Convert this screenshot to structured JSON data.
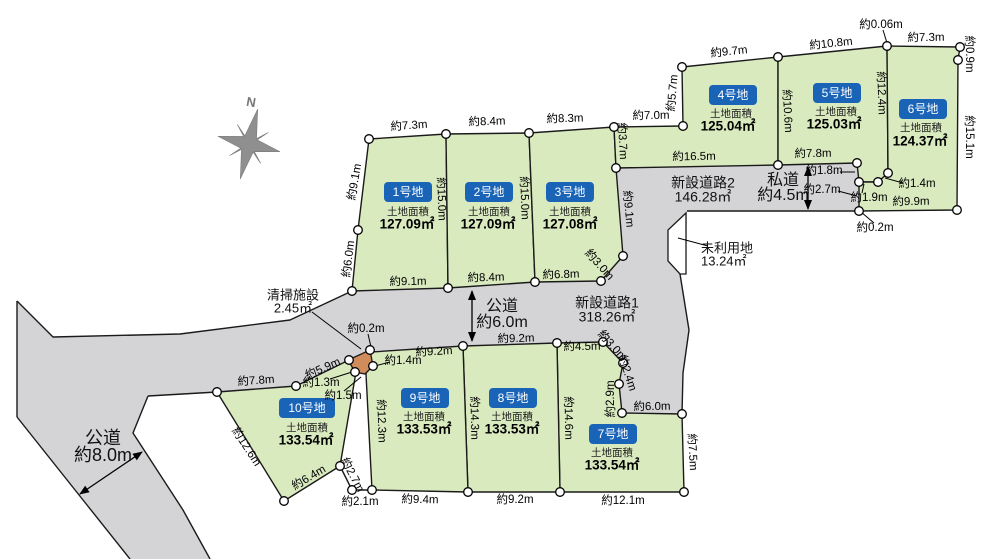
{
  "colors": {
    "background": "#ffffff",
    "lot_fill": "#d9eabf",
    "road_fill": "#d4d4d6",
    "outline": "#1a1a1a",
    "badge_fill": "#1a64b8",
    "badge_text": "#ffffff",
    "facility_fill": "#d08c5a",
    "unused_fill": "#ffffff",
    "compass_fill": "#8f8f8f",
    "dim_text": "#000000"
  },
  "compass": {
    "label": "N",
    "cx": 249,
    "cy": 144,
    "rotation": 14,
    "label_x": 251,
    "label_y": 103
  },
  "road_polygons": [
    {
      "name": "road-left-public",
      "points": "17,301 53,337 180,334 290,320 352,291 372,350 349,360 296,386 217,392 148,396 133,433 183,510 210,559 130,559 87,505 17,417"
    },
    {
      "name": "road-central-network",
      "points": "352,291 448,288 535,282 601,281 623,256 616,168 778,165 857,163 859,182 859,211 687,211 686,274 680,274 689,330 683,373 682,414 622,413 619,384 623,363 603,342 557,343 463,346 372,351 373,366 365,374 355,372 349,360 296,386 217,392 148,396"
    }
  ],
  "road_outlines": [
    {
      "name": "road-left-top-edge",
      "points": "17,301 53,337 180,334 290,320 352,291"
    },
    {
      "name": "road-left-west-edge",
      "points": "17,301 17,417"
    },
    {
      "name": "road-left-southwest-edge",
      "points": "17,417 87,505 130,559"
    },
    {
      "name": "road-left-southeast-edge",
      "points": "148,396 133,433 183,510 210,559"
    },
    {
      "name": "road-bottom-edge-west",
      "points": "148,396 217,392"
    },
    {
      "name": "private-road-bottom-edge",
      "points": "687,211 859,211"
    },
    {
      "name": "road-connector-east-edge",
      "points": "680,274 689,330 683,373 682,414"
    },
    {
      "name": "wedge-bottom-edge",
      "points": "340,466 352,490 372,490"
    }
  ],
  "unused_land": {
    "name": "unused-land-parcel",
    "points": "686,213 668,230 668,261 680,274 686,274"
  },
  "cleaning_facility": {
    "name": "cleaning-facility-parcel",
    "points": "370,350 373,366 365,374 355,372 348,360"
  },
  "lots": [
    {
      "id": 1,
      "badge": "1号地",
      "area_title": "土地面積",
      "area": "127.09㎡",
      "points": "369,139 446,134 448,288 352,291 358,230",
      "badge_cx": 408,
      "badge_cy": 192,
      "badge_w": 48,
      "title_cx": 408,
      "title_cy": 212,
      "value_cx": 407,
      "value_cy": 225
    },
    {
      "id": 2,
      "badge": "2号地",
      "area_title": "土地面積",
      "area": "127.09㎡",
      "points": "446,134 529,133 535,282 448,288",
      "badge_cx": 489,
      "badge_cy": 192,
      "badge_w": 48,
      "title_cx": 489,
      "title_cy": 212,
      "value_cx": 488,
      "value_cy": 225
    },
    {
      "id": 3,
      "badge": "3号地",
      "area_title": "土地面積",
      "area": "127.08㎡",
      "points": "529,133 614,127 616,168 623,256 601,281 535,282",
      "badge_cx": 570,
      "badge_cy": 192,
      "badge_w": 48,
      "title_cx": 570,
      "title_cy": 212,
      "value_cx": 570,
      "value_cy": 225
    },
    {
      "id": 4,
      "badge": "4号地",
      "area_title": "土地面積",
      "area": "125.04㎡",
      "points": "614,127 683,126 682,67 778,57 778,165 616,168",
      "badge_cx": 733,
      "badge_cy": 95,
      "badge_w": 48,
      "title_cx": 731,
      "title_cy": 114,
      "value_cx": 728,
      "value_cy": 127
    },
    {
      "id": 5,
      "badge": "5号地",
      "area_title": "土地面積",
      "area": "125.03㎡",
      "points": "778,57 887,46 888,173 878,182 859,182 857,163 778,165",
      "badge_cx": 837,
      "badge_cy": 93,
      "badge_w": 48,
      "title_cx": 836,
      "title_cy": 112,
      "value_cx": 834,
      "value_cy": 125
    },
    {
      "id": 6,
      "badge": "6号地",
      "area_title": "土地面積",
      "area": "124.37㎡",
      "points": "887,46 960,47 958,60 957,210 859,211 859,182 878,182 888,173",
      "badge_cx": 923,
      "badge_cy": 109,
      "badge_w": 48,
      "title_cx": 921,
      "title_cy": 128,
      "value_cx": 920,
      "value_cy": 142
    },
    {
      "id": 7,
      "badge": "7号地",
      "area_title": "土地面積",
      "area": "133.54㎡",
      "points": "557,343 603,342 623,363 619,384 622,413 682,414 684,492 560,492",
      "badge_cx": 613,
      "badge_cy": 434,
      "badge_w": 48,
      "title_cx": 612,
      "title_cy": 453,
      "value_cx": 612,
      "value_cy": 466
    },
    {
      "id": 8,
      "badge": "8号地",
      "area_title": "土地面積",
      "area": "133.53㎡",
      "points": "463,346 557,343 560,492 468,492",
      "badge_cx": 513,
      "badge_cy": 398,
      "badge_w": 48,
      "title_cx": 512,
      "title_cy": 417,
      "value_cx": 512,
      "value_cy": 430
    },
    {
      "id": 9,
      "badge": "9号地",
      "area_title": "土地面積",
      "area": "133.53㎡",
      "points": "371,352 463,346 468,492 372,490 366,374",
      "badge_cx": 425,
      "badge_cy": 398,
      "badge_w": 48,
      "title_cx": 424,
      "title_cy": 417,
      "value_cx": 424,
      "value_cy": 430
    },
    {
      "id": 10,
      "badge": "10号地",
      "area_title": "土地面積",
      "area": "133.54㎡",
      "points": "217,392 296,386 349,360 356,372 340,466 284,501",
      "badge_cx": 307,
      "badge_cy": 408,
      "badge_w": 56,
      "title_cx": 307,
      "title_cy": 428,
      "value_cx": 306,
      "value_cy": 441
    }
  ],
  "road_labels": [
    {
      "name": "public-road-8m-label",
      "lines": [
        "公道",
        "約8.0m"
      ],
      "x": 103,
      "y": 439,
      "size": 18,
      "lh": 17,
      "anchor": "middle"
    },
    {
      "name": "public-road-6m-label",
      "lines": [
        "公道",
        "約6.0m"
      ],
      "x": 502,
      "y": 307,
      "size": 16,
      "lh": 16,
      "anchor": "middle"
    },
    {
      "name": "new-road-1-label",
      "lines": [
        "新設道路1",
        "318.26㎡"
      ],
      "x": 607,
      "y": 304,
      "size": 14,
      "lh": 14,
      "anchor": "middle"
    },
    {
      "name": "new-road-2-label",
      "lines": [
        "新設道路2",
        "146.28㎡"
      ],
      "x": 703,
      "y": 184,
      "size": 14,
      "lh": 14,
      "anchor": "middle"
    },
    {
      "name": "private-road-label",
      "lines": [
        "私道",
        "約4.5m"
      ],
      "x": 783,
      "y": 181,
      "size": 16,
      "lh": 15,
      "anchor": "middle"
    },
    {
      "name": "unused-land-label",
      "lines": [
        "未利用地",
        "13.24㎡"
      ],
      "x": 701,
      "y": 249,
      "size": 13,
      "lh": 13,
      "anchor": "start"
    },
    {
      "name": "cleaning-facility-label",
      "lines": [
        "清掃施設",
        "2.45㎡"
      ],
      "x": 293,
      "y": 296,
      "size": 13,
      "lh": 13,
      "anchor": "middle"
    }
  ],
  "dim_labels": [
    {
      "t": "約7.3m",
      "x": 409,
      "y": 126,
      "r": -4
    },
    {
      "t": "約8.4m",
      "x": 487,
      "y": 122,
      "r": -2
    },
    {
      "t": "約8.3m",
      "x": 565,
      "y": 119,
      "r": -2
    },
    {
      "t": "約7.0m",
      "x": 651,
      "y": 116,
      "r": -1
    },
    {
      "t": "約9.7m",
      "x": 729,
      "y": 52,
      "r": -6
    },
    {
      "t": "約10.8m",
      "x": 831,
      "y": 44,
      "r": -6
    },
    {
      "t": "約0.06m",
      "x": 881,
      "y": 25,
      "r": 0
    },
    {
      "t": "約7.3m",
      "x": 926,
      "y": 38,
      "r": -1
    },
    {
      "t": "約0.9m",
      "x": 969,
      "y": 54,
      "r": 90
    },
    {
      "t": "約15.1m",
      "x": 969,
      "y": 137,
      "r": 90
    },
    {
      "t": "約5.7m",
      "x": 673,
      "y": 93,
      "r": -85
    },
    {
      "t": "約10.6m",
      "x": 787,
      "y": 111,
      "r": 87
    },
    {
      "t": "約12.4m",
      "x": 881,
      "y": 93,
      "r": 88
    },
    {
      "t": "約9.1m",
      "x": 355,
      "y": 182,
      "r": -80
    },
    {
      "t": "約6.0m",
      "x": 349,
      "y": 259,
      "r": -83
    },
    {
      "t": "約15.0m",
      "x": 441,
      "y": 199,
      "r": 88
    },
    {
      "t": "約15.0m",
      "x": 524,
      "y": 198,
      "r": 88
    },
    {
      "t": "約3.7m",
      "x": 622,
      "y": 141,
      "r": 87
    },
    {
      "t": "約9.1m",
      "x": 628,
      "y": 209,
      "r": 85
    },
    {
      "t": "約3.0m",
      "x": 599,
      "y": 265,
      "r": 48
    },
    {
      "t": "約9.1m",
      "x": 408,
      "y": 282,
      "r": -1
    },
    {
      "t": "約8.4m",
      "x": 486,
      "y": 278,
      "r": -2
    },
    {
      "t": "約6.8m",
      "x": 561,
      "y": 275,
      "r": -2
    },
    {
      "t": "約16.5m",
      "x": 694,
      "y": 157,
      "r": -1
    },
    {
      "t": "約7.8m",
      "x": 813,
      "y": 154,
      "r": -1
    },
    {
      "t": "約1.8m",
      "x": 824,
      "y": 171,
      "r": 0
    },
    {
      "t": "約2.7m",
      "x": 822,
      "y": 190,
      "r": 0
    },
    {
      "t": "約1.9m",
      "x": 869,
      "y": 198,
      "r": 0
    },
    {
      "t": "約1.4m",
      "x": 917,
      "y": 184,
      "r": 0
    },
    {
      "t": "約9.9m",
      "x": 911,
      "y": 202,
      "r": -1
    },
    {
      "t": "約0.2m",
      "x": 875,
      "y": 228,
      "r": 0
    },
    {
      "t": "約9.2m",
      "x": 434,
      "y": 352,
      "r": -3
    },
    {
      "t": "約9.2m",
      "x": 516,
      "y": 339,
      "r": -2
    },
    {
      "t": "約4.5m",
      "x": 582,
      "y": 347,
      "r": -1
    },
    {
      "t": "約3.0m",
      "x": 612,
      "y": 346,
      "r": 48
    },
    {
      "t": "約2.4m",
      "x": 627,
      "y": 373,
      "r": 72
    },
    {
      "t": "約2.9m",
      "x": 611,
      "y": 399,
      "r": -90
    },
    {
      "t": "約6.0m",
      "x": 652,
      "y": 407,
      "r": -1
    },
    {
      "t": "約12.3m",
      "x": 381,
      "y": 421,
      "r": 88
    },
    {
      "t": "約14.3m",
      "x": 474,
      "y": 418,
      "r": 89
    },
    {
      "t": "約14.6m",
      "x": 568,
      "y": 418,
      "r": 89
    },
    {
      "t": "約7.5m",
      "x": 692,
      "y": 452,
      "r": 87
    },
    {
      "t": "約9.4m",
      "x": 420,
      "y": 500,
      "r": 1
    },
    {
      "t": "約9.2m",
      "x": 515,
      "y": 500,
      "r": 0
    },
    {
      "t": "約12.1m",
      "x": 623,
      "y": 501,
      "r": 0
    },
    {
      "t": "約2.1m",
      "x": 360,
      "y": 502,
      "r": 0
    },
    {
      "t": "約2.7m",
      "x": 352,
      "y": 475,
      "r": 62
    },
    {
      "t": "約6.4m",
      "x": 309,
      "y": 478,
      "r": -31
    },
    {
      "t": "約12.6m",
      "x": 246,
      "y": 447,
      "r": 57
    },
    {
      "t": "約7.8m",
      "x": 256,
      "y": 381,
      "r": -4
    },
    {
      "t": "約5.9m",
      "x": 323,
      "y": 369,
      "r": -24
    },
    {
      "t": "約1.3m",
      "x": 321,
      "y": 383,
      "r": 0
    },
    {
      "t": "約1.5m",
      "x": 343,
      "y": 396,
      "r": 0
    },
    {
      "t": "約1.4m",
      "x": 403,
      "y": 361,
      "r": 0
    },
    {
      "t": "約0.2m",
      "x": 366,
      "y": 329,
      "r": 0
    }
  ],
  "leaders": [
    [
      312,
      312,
      361,
      349
    ],
    [
      708,
      246,
      678,
      238
    ],
    [
      883,
      30,
      887,
      43
    ],
    [
      840,
      172,
      855,
      172
    ],
    [
      838,
      191,
      857,
      196
    ],
    [
      862,
      193,
      864,
      184
    ],
    [
      903,
      183,
      885,
      178
    ],
    [
      874,
      223,
      861,
      212
    ],
    [
      368,
      334,
      371,
      347
    ],
    [
      390,
      362,
      375,
      366
    ],
    [
      330,
      379,
      352,
      372
    ],
    [
      344,
      391,
      361,
      377
    ]
  ],
  "arrows": [
    {
      "name": "road-6m-width-arrow",
      "x1": 472,
      "y1": 291,
      "x2": 472,
      "y2": 341
    },
    {
      "name": "private-road-width-arrow",
      "x1": 808,
      "y1": 167,
      "x2": 808,
      "y2": 209
    },
    {
      "name": "road-8m-width-arrow",
      "x1": 142,
      "y1": 452,
      "x2": 80,
      "y2": 494
    }
  ],
  "vertices": [
    [
      369,
      139
    ],
    [
      446,
      134
    ],
    [
      529,
      133
    ],
    [
      614,
      127
    ],
    [
      616,
      168
    ],
    [
      623,
      256
    ],
    [
      601,
      281
    ],
    [
      535,
      282
    ],
    [
      448,
      288
    ],
    [
      352,
      291
    ],
    [
      358,
      230
    ],
    [
      683,
      126
    ],
    [
      682,
      67
    ],
    [
      778,
      57
    ],
    [
      887,
      46
    ],
    [
      960,
      47
    ],
    [
      958,
      60
    ],
    [
      957,
      210
    ],
    [
      859,
      211
    ],
    [
      859,
      182
    ],
    [
      878,
      182
    ],
    [
      888,
      173
    ],
    [
      857,
      163
    ],
    [
      778,
      165
    ],
    [
      603,
      342
    ],
    [
      623,
      363
    ],
    [
      619,
      384
    ],
    [
      622,
      413
    ],
    [
      682,
      414
    ],
    [
      684,
      492
    ],
    [
      557,
      343
    ],
    [
      463,
      346
    ],
    [
      468,
      492
    ],
    [
      560,
      492
    ],
    [
      372,
      490
    ],
    [
      352,
      490
    ],
    [
      340,
      466
    ],
    [
      284,
      501
    ],
    [
      217,
      392
    ],
    [
      296,
      386
    ],
    [
      349,
      360
    ],
    [
      355,
      372
    ],
    [
      370,
      350
    ],
    [
      373,
      366
    ]
  ]
}
